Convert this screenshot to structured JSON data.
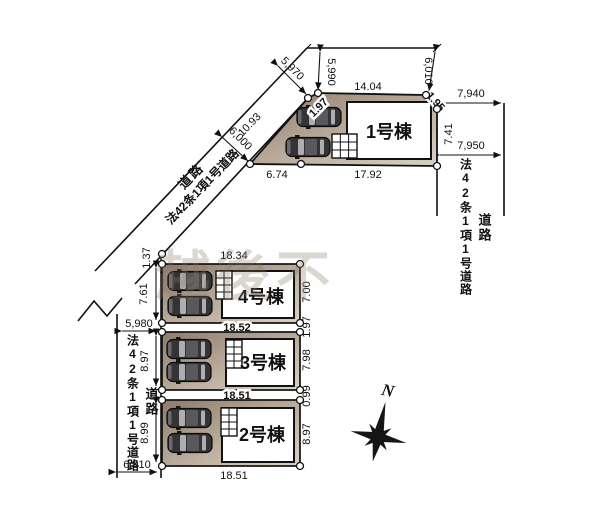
{
  "plan": {
    "compass_label": "N",
    "watermark": "越後不",
    "roads": {
      "diagonal": {
        "label": "道路",
        "law_label": "法42条1項1号道路",
        "width_upper": "5,970",
        "width_lower": "6,000"
      },
      "right": {
        "label": "道路",
        "law_label": "法42条1項1号道路",
        "width_upper": "7,940",
        "width_lower": "7,950"
      },
      "left": {
        "label": "道路",
        "law_label": "法42条1項1号道路",
        "width_upper": "5,980",
        "width_lower": "6,010"
      }
    },
    "lots": [
      {
        "building": "1号棟",
        "dims": {
          "top_offset_left": "5,990",
          "top_offset_right": "6,010",
          "top": "14.04",
          "jog_left": "1.97",
          "jog_right": "1.95",
          "right_side": "7.41",
          "road_edge": "10.93",
          "bottom_left": "6.74",
          "bottom": "17.92"
        }
      },
      {
        "building": "4号棟",
        "dims": {
          "top": "18.34",
          "left_upper": "1.37",
          "left": "7.61",
          "right": "7.00",
          "right_lower": "1.97",
          "bottom": "18.52"
        }
      },
      {
        "building": "3号棟",
        "dims": {
          "left": "8.97",
          "right": "7.98",
          "right_lower": "0.99",
          "bottom": "18.51"
        }
      },
      {
        "building": "2号棟",
        "dims": {
          "left": "8.99",
          "right": "8.97",
          "bottom": "18.51"
        }
      }
    ],
    "colors": {
      "lot_fill_dark": "#8d7b6c",
      "lot_fill_light": "#d9d0c5",
      "line": "#1a1a1a",
      "watermark": "#8a7a66"
    }
  }
}
